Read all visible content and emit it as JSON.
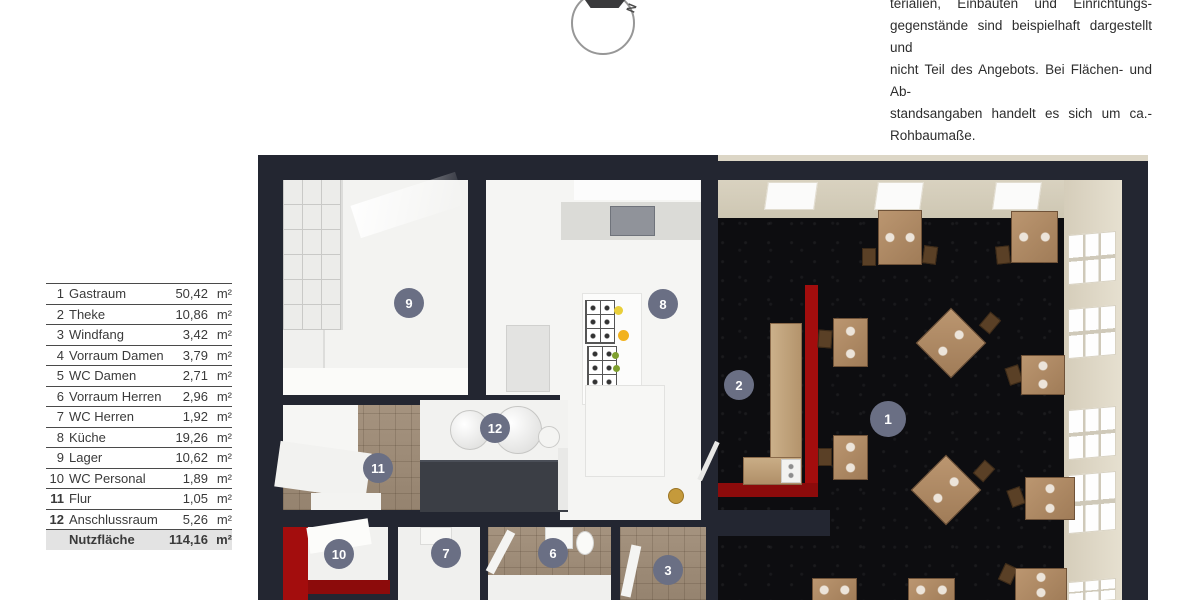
{
  "room_table": {
    "rows": [
      {
        "no": "1",
        "name": "Gastraum",
        "area": "50,42",
        "unit": "m²"
      },
      {
        "no": "2",
        "name": "Theke",
        "area": "10,86",
        "unit": "m²"
      },
      {
        "no": "3",
        "name": "Windfang",
        "area": "3,42",
        "unit": "m²"
      },
      {
        "no": "4",
        "name": "Vorraum Damen",
        "area": "3,79",
        "unit": "m²"
      },
      {
        "no": "5",
        "name": "WC Damen",
        "area": "2,71",
        "unit": "m²"
      },
      {
        "no": "6",
        "name": "Vorraum Herren",
        "area": "2,96",
        "unit": "m²"
      },
      {
        "no": "7",
        "name": "WC Herren",
        "area": "1,92",
        "unit": "m²"
      },
      {
        "no": "8",
        "name": "Küche",
        "area": "19,26",
        "unit": "m²"
      },
      {
        "no": "9",
        "name": "Lager",
        "area": "10,62",
        "unit": "m²"
      },
      {
        "no": "10",
        "name": "WC Personal",
        "area": "1,89",
        "unit": "m²"
      },
      {
        "no": "11",
        "name": "Flur",
        "area": "1,05",
        "unit": "m²"
      },
      {
        "no": "12",
        "name": "Anschlussraum",
        "area": "5,26",
        "unit": "m²"
      }
    ],
    "total_label": "Nutzfläche",
    "total_area": "114,16",
    "total_unit": "m²"
  },
  "disclaimer": {
    "lines": [
      "terialien, Einbauten und Einrichtungs-",
      "gegenstände sind beispielhaft dargestellt und",
      "nicht Teil des Angebots. Bei Flächen- und Ab-",
      "standsangaben handelt es sich um ca.-",
      "Rohbaumaße."
    ]
  },
  "compass": {
    "north_label": "N"
  },
  "floorplan": {
    "badges": [
      {
        "label": "9"
      },
      {
        "label": "8"
      },
      {
        "label": "1"
      },
      {
        "label": "2"
      },
      {
        "label": "12"
      },
      {
        "label": "11"
      },
      {
        "label": "10"
      },
      {
        "label": "7"
      },
      {
        "label": "6"
      },
      {
        "label": "3"
      }
    ],
    "colors": {
      "wall": "#232631",
      "badge": "#6a6f84",
      "accent_red": "#a30d0d",
      "wood": "#b08a67",
      "marble_floor": "#0d0d10",
      "tile": "#9e8c79",
      "beige_wall": "#d9d2c0"
    }
  }
}
